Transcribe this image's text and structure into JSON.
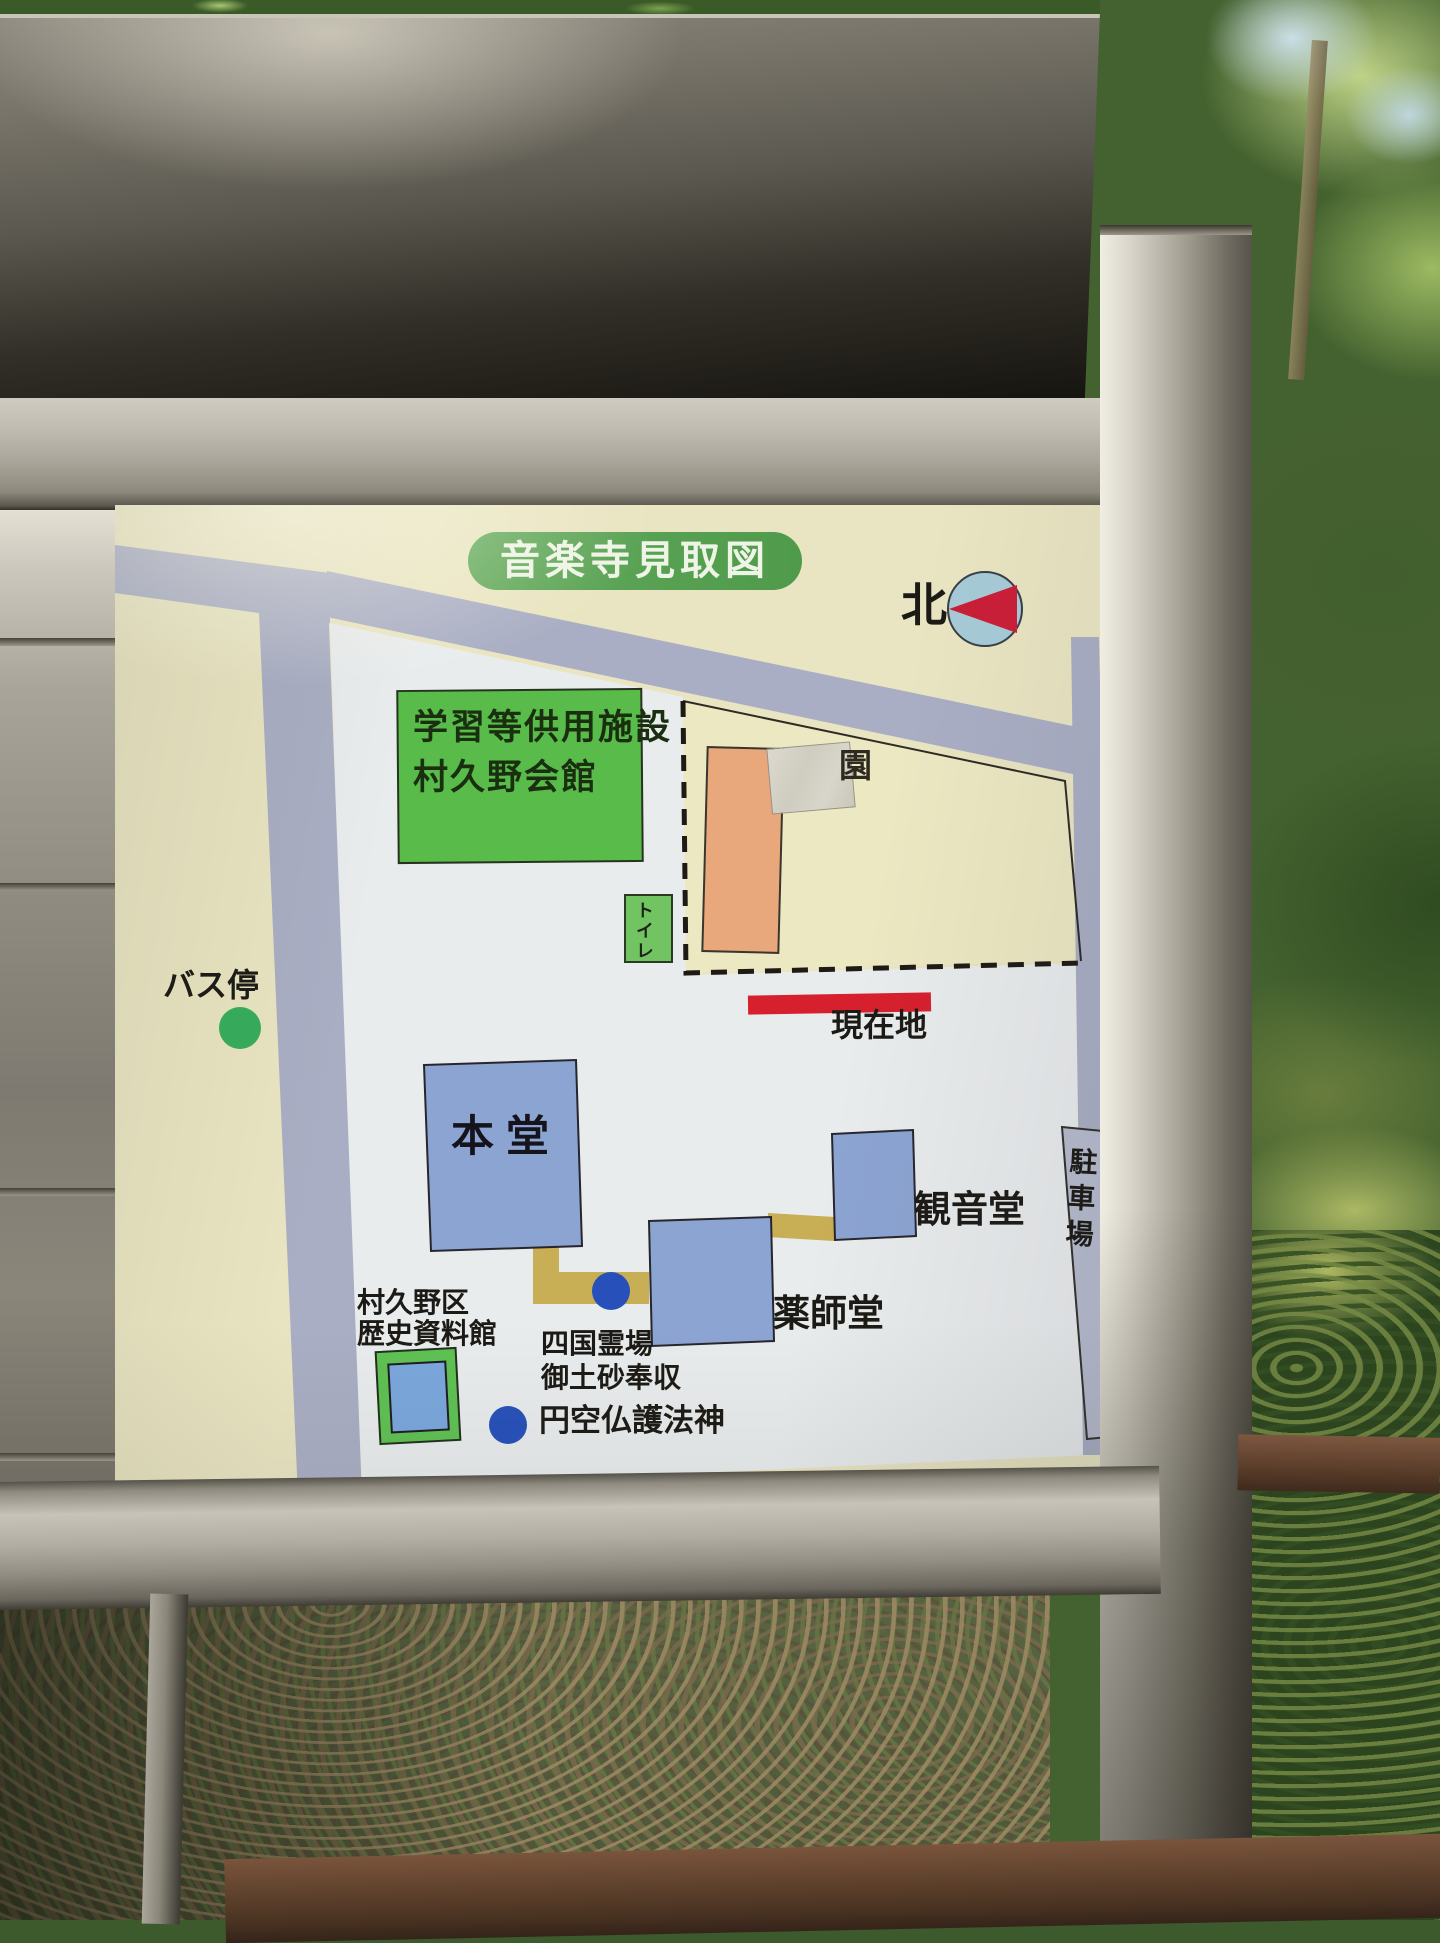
{
  "board": {
    "title": "音楽寺見取図",
    "compass": {
      "label": "北"
    },
    "labels": {
      "facility_line1": "学習等供用施設",
      "facility_line2": "村久野会館",
      "nursery_partial": "園",
      "toilet": "トイレ",
      "current_location": "現在地",
      "bus_stop": "バス停",
      "main_hall": "本 堂",
      "kannon_hall": "観音堂",
      "yakushi_hall": "薬師堂",
      "parking": "駐車場",
      "museum_line1": "村久野区",
      "museum_line2": "歴史資料館",
      "shikoku_line1": "四国霊場",
      "shikoku_line2": "御土砂奉収",
      "enku_deity": "円空仏護法神"
    },
    "colors": {
      "board_cream": "#e9e5c2",
      "temple_grounds_white": "#e9eced",
      "road_gray": "#a9aec4",
      "title_green": "#58a150",
      "building_green": "#58bb4a",
      "building_blue": "#8ca4d2",
      "building_orange": "#e9a87c",
      "path_tan": "#c8ae54",
      "marker_red": "#d7202d",
      "dot_green": "#35ad5b",
      "dot_blue": "#2750ba",
      "compass_circle_blue": "#a6cbd7"
    }
  }
}
